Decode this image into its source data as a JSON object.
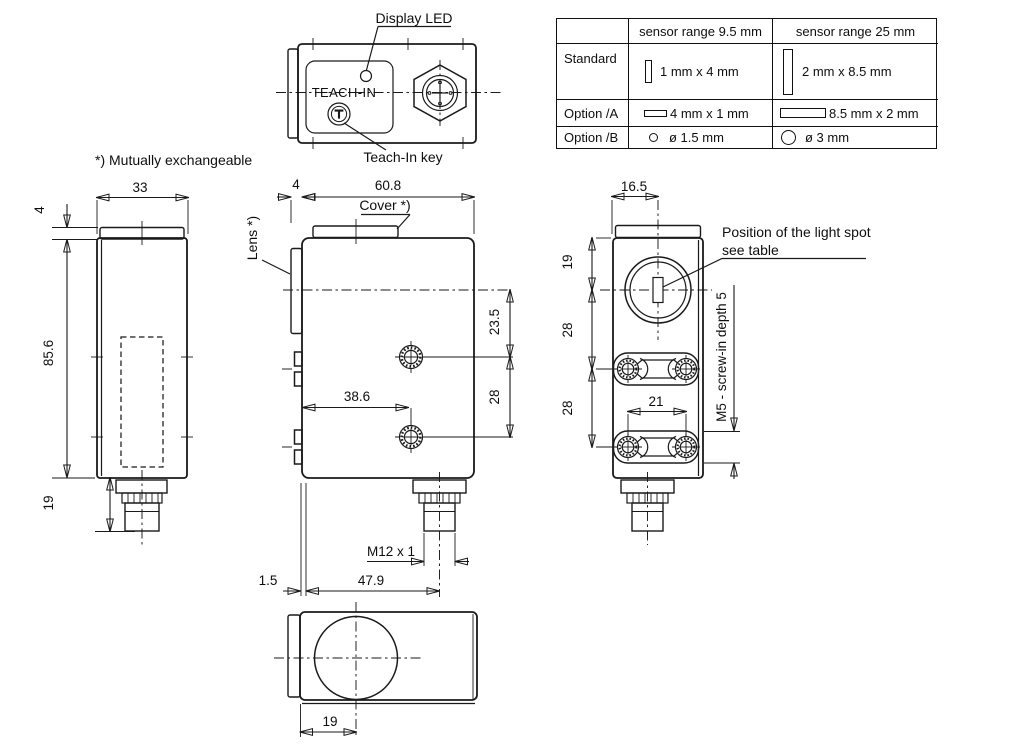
{
  "colors": {
    "line": "#1a1a1a",
    "background": "#ffffff"
  },
  "note": "*) Mutually exchangeable",
  "top_view": {
    "display_led": "Display LED",
    "teach_in": "TEACH-IN",
    "teach_in_key": "Teach-In key"
  },
  "spec_table": {
    "headers": {
      "col1": "sensor range 9.5 mm",
      "col2": "sensor range 25 mm"
    },
    "rows": [
      {
        "label": "Standard",
        "icon1": "slit-vertical-small",
        "val1": "1 mm x 4 mm",
        "icon2": "slit-vertical-large",
        "val2": "2 mm x 8.5 mm"
      },
      {
        "label": "Option /A",
        "icon1": "slit-horizontal-small",
        "val1": "4 mm x 1 mm",
        "icon2": "slit-horizontal-large",
        "val2": "8.5 mm x 2 mm"
      },
      {
        "label": "Option /B",
        "icon1": "hole-small",
        "val1": "ø 1.5 mm",
        "icon2": "hole-large",
        "val2": "ø 3 mm"
      }
    ]
  },
  "left_view": {
    "dim_width": "33",
    "dim_lens": "4",
    "dim_height": "85.6",
    "dim_connector": "19"
  },
  "center_view": {
    "dim_lens_width": "4",
    "dim_width": "60.8",
    "label_cover": "Cover *)",
    "label_lens": "Lens *)",
    "dim_axis_hole": "23.5",
    "dim_holes": "28",
    "dim_hole_x": "38.6",
    "label_thread": "M12 x 1",
    "dim_edge": "1.5",
    "dim_connector_x": "47.9"
  },
  "right_view": {
    "dim_spot_x": "16.5",
    "dim_spot_y": "19",
    "dim_span1": "28",
    "dim_span2": "28",
    "dim_screws": "21",
    "label_screw": "M5 - screw-in depth 5",
    "label_spot1": "Position of the light spot",
    "label_spot2": "see table"
  },
  "bottom_view": {
    "dim_lens_x": "19"
  }
}
